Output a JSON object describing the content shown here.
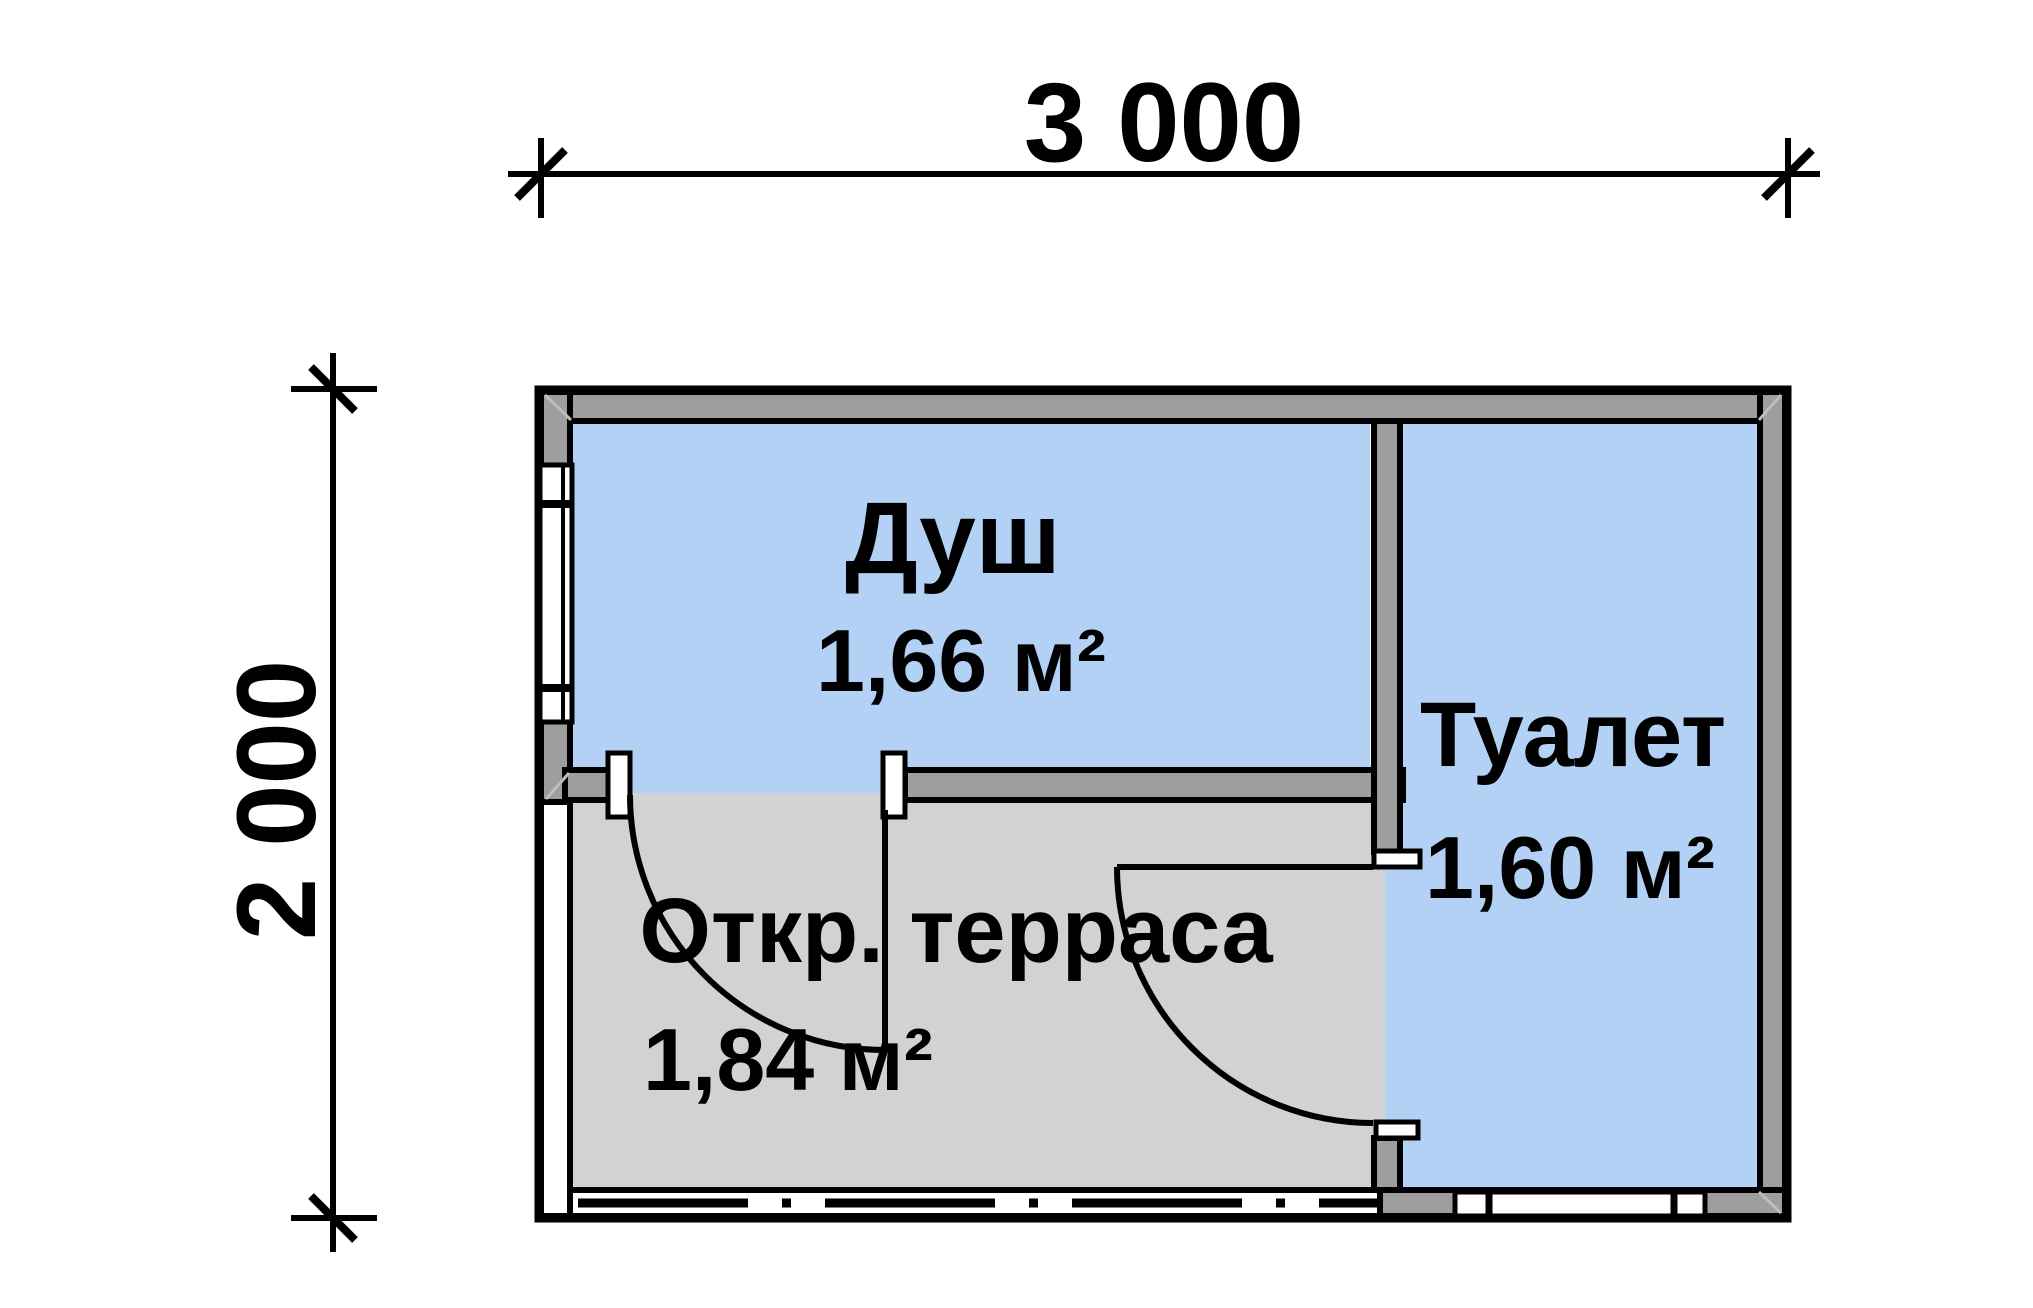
{
  "drawing": {
    "type": "floor-plan",
    "dimension_top": {
      "label": "3 000"
    },
    "dimension_left": {
      "label": "2 000"
    },
    "rooms": [
      {
        "name": "Душ",
        "area": "1,66 м²"
      },
      {
        "name": "Туалет",
        "area": "1,60 м²"
      },
      {
        "name": "Откр. терраса",
        "area": "1,84 м²"
      }
    ],
    "colors": {
      "room_fill": "#b3d1f5",
      "terrace_fill": "#d2d2d2",
      "wall_fill": "#9e9e9e",
      "line": "#000000",
      "background": "#ffffff"
    }
  }
}
